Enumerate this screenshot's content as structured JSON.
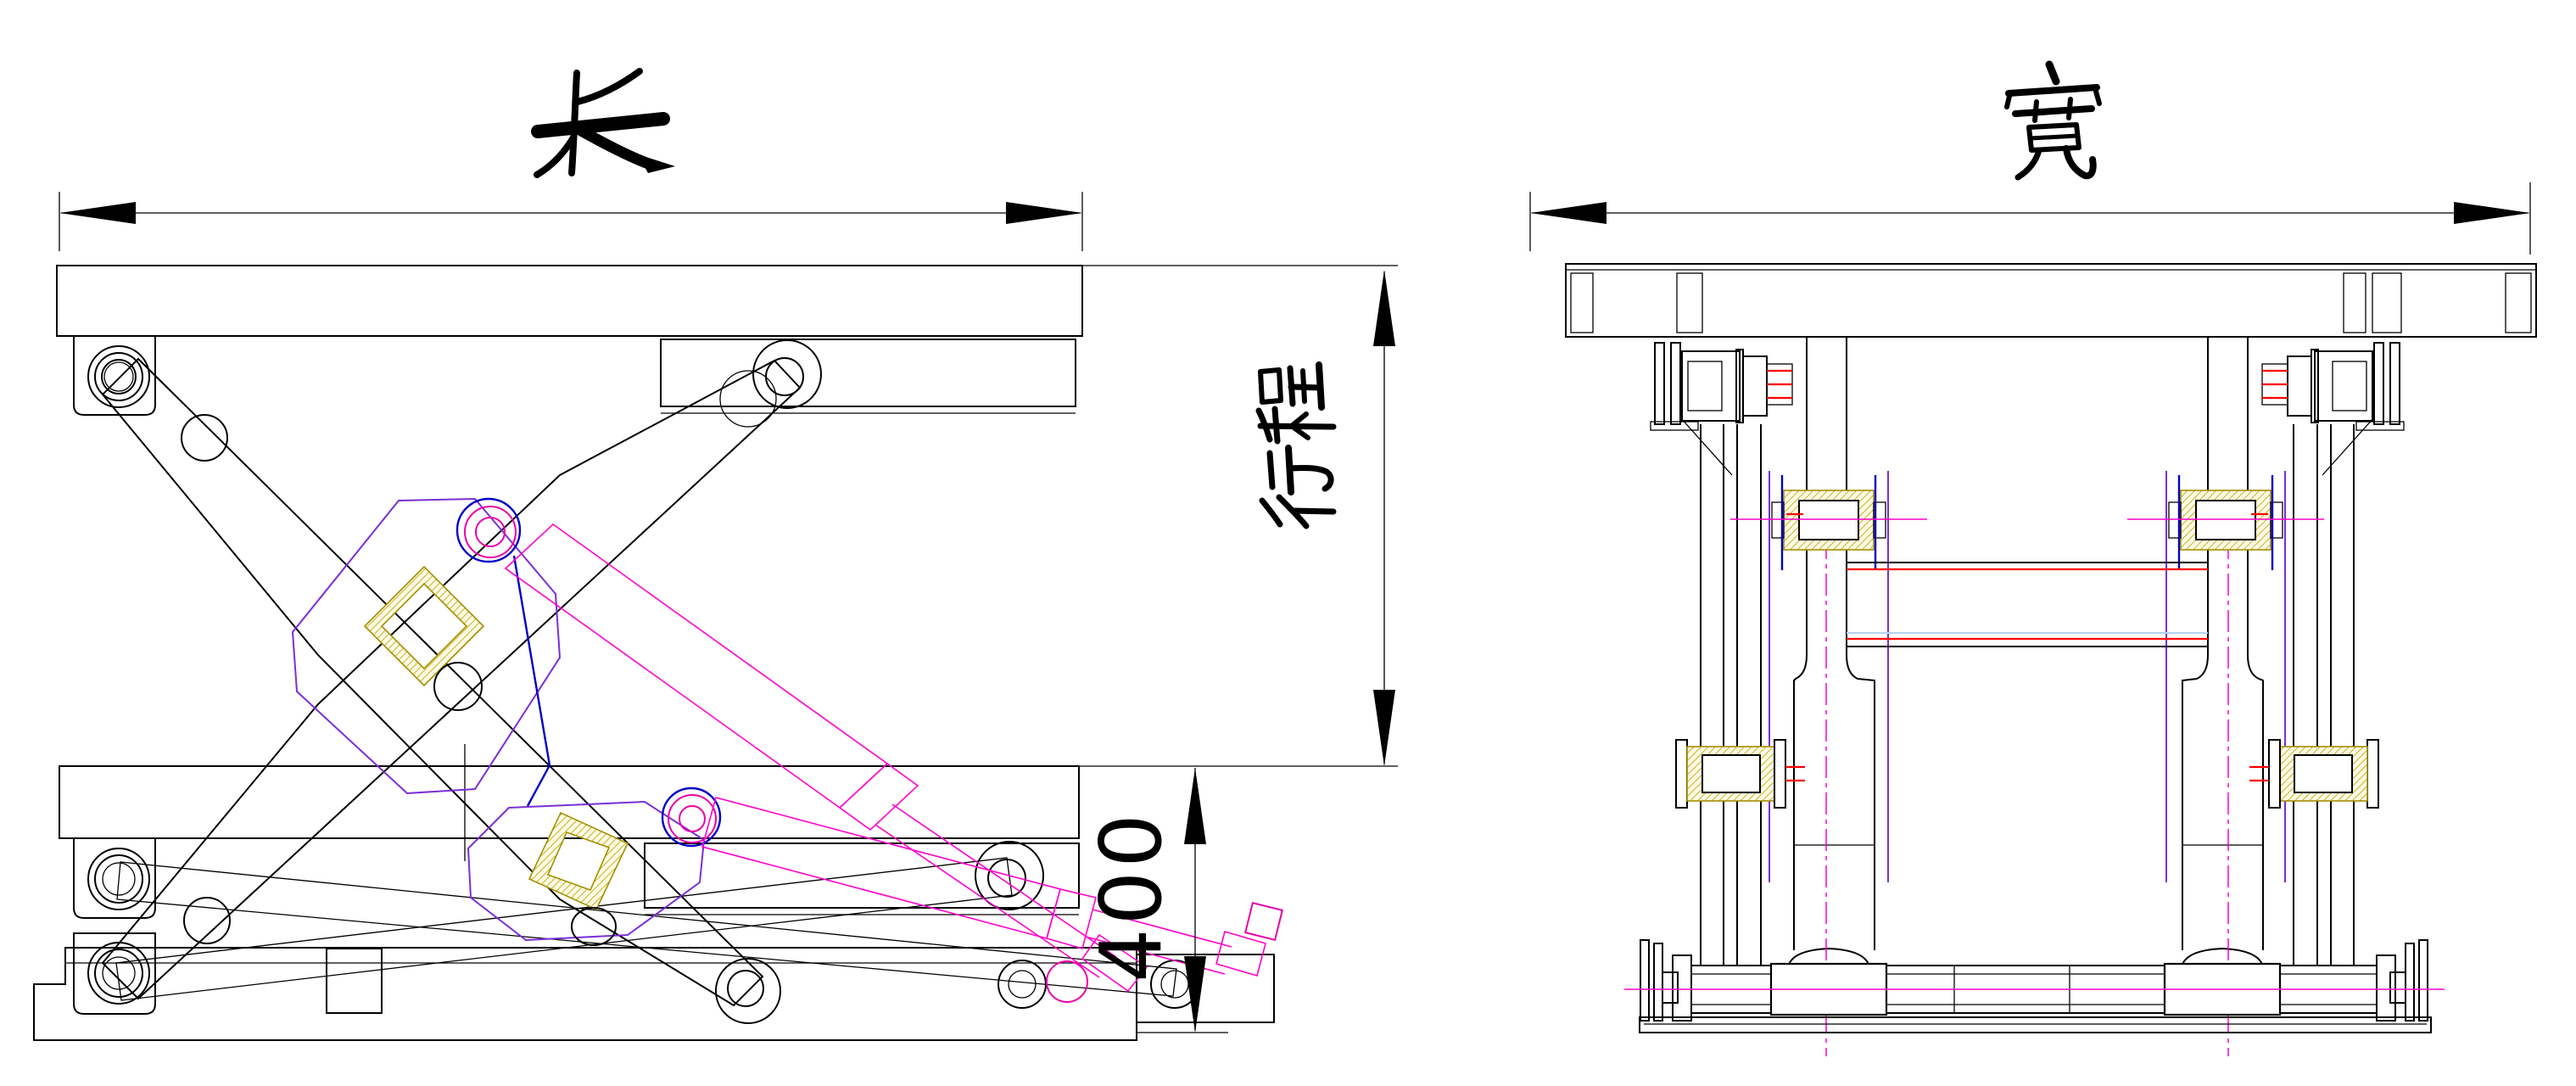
{
  "drawing": {
    "type": "cad-technical-drawing",
    "subject": "scissor-lift-mechanism-two-views",
    "background": "#ffffff",
    "views": [
      {
        "id": "side-view",
        "description": "side elevation with extended and collapsed states overlaid"
      },
      {
        "id": "front-view",
        "description": "front elevation"
      }
    ],
    "dimensions": {
      "length": {
        "label": "长"
      },
      "width": {
        "label": "宽"
      },
      "stroke": {
        "label": "行程",
        "char_top": "程",
        "char_bottom": "行"
      },
      "collapsed_height": {
        "value": "400"
      }
    },
    "colors": {
      "line": "#000000",
      "magenta": "#ff00cc",
      "deep_pink": "#e800a8",
      "purple": "#7a2fd6",
      "blue": "#0000c8",
      "pale_blue": "#b4d2f0",
      "yellow_hatch": "#c8a800",
      "red": "#ff0000"
    }
  }
}
